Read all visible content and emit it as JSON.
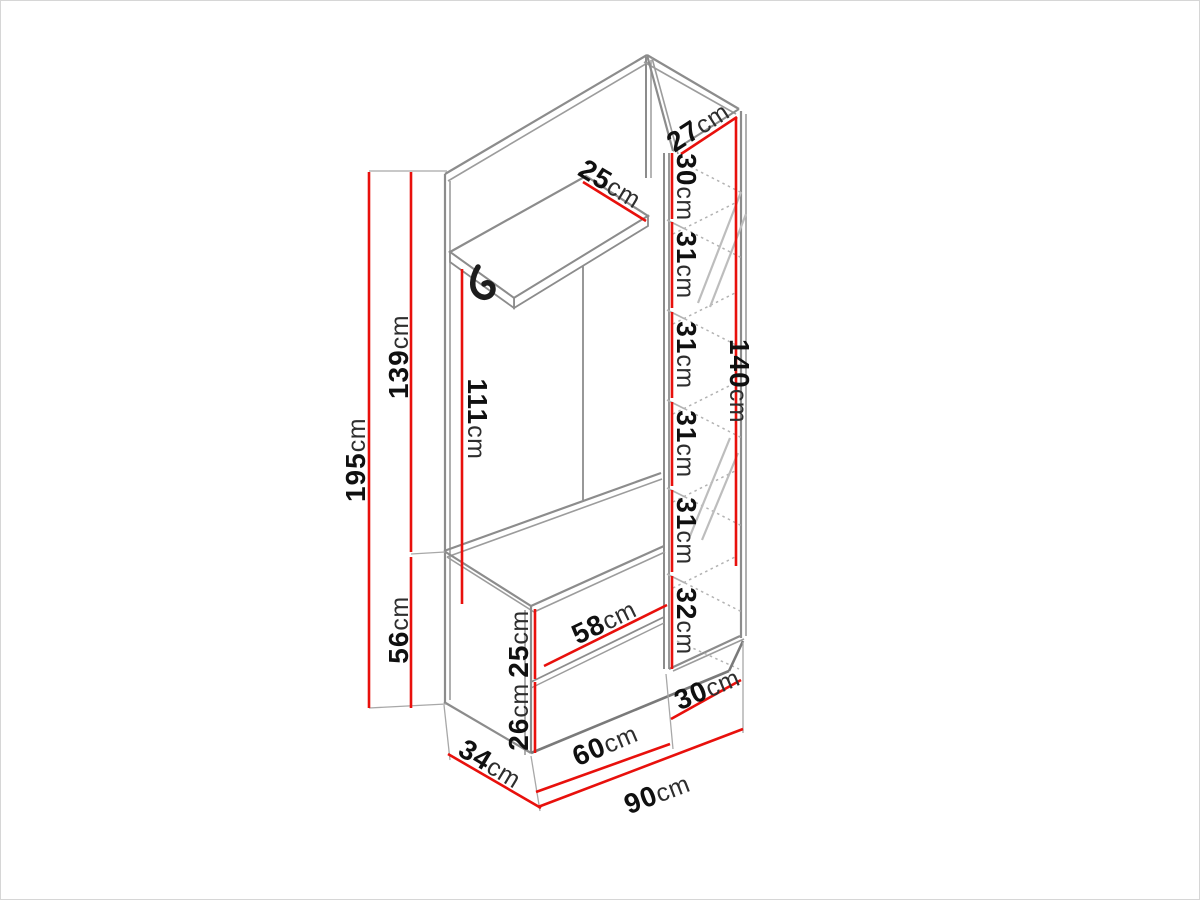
{
  "meta": {
    "type": "furniture-dimension-diagram",
    "subject": "Hallway wardrobe set: back panel with hat shelf and hook, mirrored shoe column and drawer bench, isometric view with dimensions",
    "unit": "cm"
  },
  "colors": {
    "background": "#ffffff",
    "outline_gray": "#8c8c8c",
    "dimension_red": "#e8100c",
    "text_black": "#101010",
    "hatch_gray": "#bdbdbd"
  },
  "dims": {
    "total_height": {
      "value": "195",
      "unit": "cm"
    },
    "upper_section_height": {
      "value": "139",
      "unit": "cm"
    },
    "bench_height": {
      "value": "56",
      "unit": "cm"
    },
    "open_inner_height": {
      "value": "111",
      "unit": "cm"
    },
    "shelf_depth": {
      "value": "25",
      "unit": "cm"
    },
    "column_top_depth": {
      "value": "27",
      "unit": "cm"
    },
    "column_comp_top": {
      "value": "30",
      "unit": "cm"
    },
    "column_comp_1": {
      "value": "31",
      "unit": "cm"
    },
    "column_comp_2": {
      "value": "31",
      "unit": "cm"
    },
    "column_comp_3": {
      "value": "31",
      "unit": "cm"
    },
    "column_comp_4": {
      "value": "31",
      "unit": "cm"
    },
    "column_comp_bottom": {
      "value": "32",
      "unit": "cm"
    },
    "column_height": {
      "value": "140",
      "unit": "cm"
    },
    "drawer_width": {
      "value": "58",
      "unit": "cm"
    },
    "upper_drawer_height": {
      "value": "25",
      "unit": "cm"
    },
    "lower_drawer_height": {
      "value": "26",
      "unit": "cm"
    },
    "bench_section_width": {
      "value": "60",
      "unit": "cm"
    },
    "column_width": {
      "value": "30",
      "unit": "cm"
    },
    "bench_depth": {
      "value": "34",
      "unit": "cm"
    },
    "total_width": {
      "value": "90",
      "unit": "cm"
    }
  }
}
